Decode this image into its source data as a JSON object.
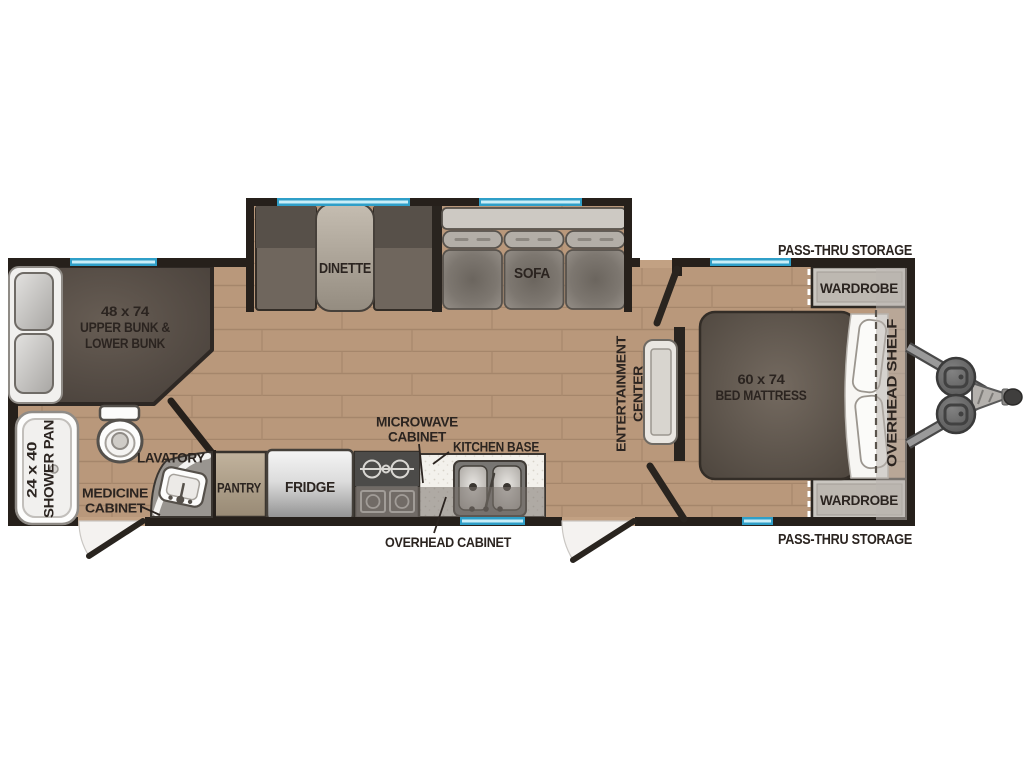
{
  "title": "Travel trailer floor plan",
  "colors": {
    "wall": "#26201b",
    "floor": "#b9987b",
    "floor_line": "#a5866b",
    "window_teal": "#2f9fc8",
    "window_light": "#c9eef8",
    "label_text": "#2b2420",
    "dark_furniture": "#5f564e",
    "white_fixture": "#f6f5f3",
    "overlay_gray": "#767069"
  },
  "rooms": {
    "bunk": {
      "line1": "48 x 74",
      "line2": "UPPER BUNK &",
      "line3": "LOWER BUNK"
    },
    "shower": {
      "line1": "24 x 40",
      "line2": "SHOWER PAN"
    },
    "lavatory": {
      "label": "LAVATORY"
    },
    "medicine_cabinet": {
      "line1": "MEDICINE",
      "line2": "CABINET"
    },
    "pantry": {
      "label": "PANTRY"
    },
    "fridge": {
      "label": "FRIDGE"
    },
    "microwave_cabinet": {
      "line1": "MICROWAVE",
      "line2": "CABINET"
    },
    "kitchen_base": {
      "label": "KITCHEN BASE"
    },
    "overhead_cabinet": {
      "label": "OVERHEAD CABINET"
    },
    "dinette": {
      "label": "DINETTE"
    },
    "sofa": {
      "label": "SOFA"
    },
    "entertainment_center": {
      "line1": "ENTERTAINMENT",
      "line2": "CENTER"
    },
    "bed": {
      "line1": "60 x 74",
      "line2": "BED MATTRESS"
    },
    "overhead_shelf": {
      "label": "OVERHEAD SHELF"
    },
    "wardrobe_top": {
      "label": "WARDROBE"
    },
    "wardrobe_bottom": {
      "label": "WARDROBE"
    },
    "pass_thru_top": {
      "label": "PASS-THRU STORAGE"
    },
    "pass_thru_bottom": {
      "label": "PASS-THRU STORAGE"
    }
  }
}
